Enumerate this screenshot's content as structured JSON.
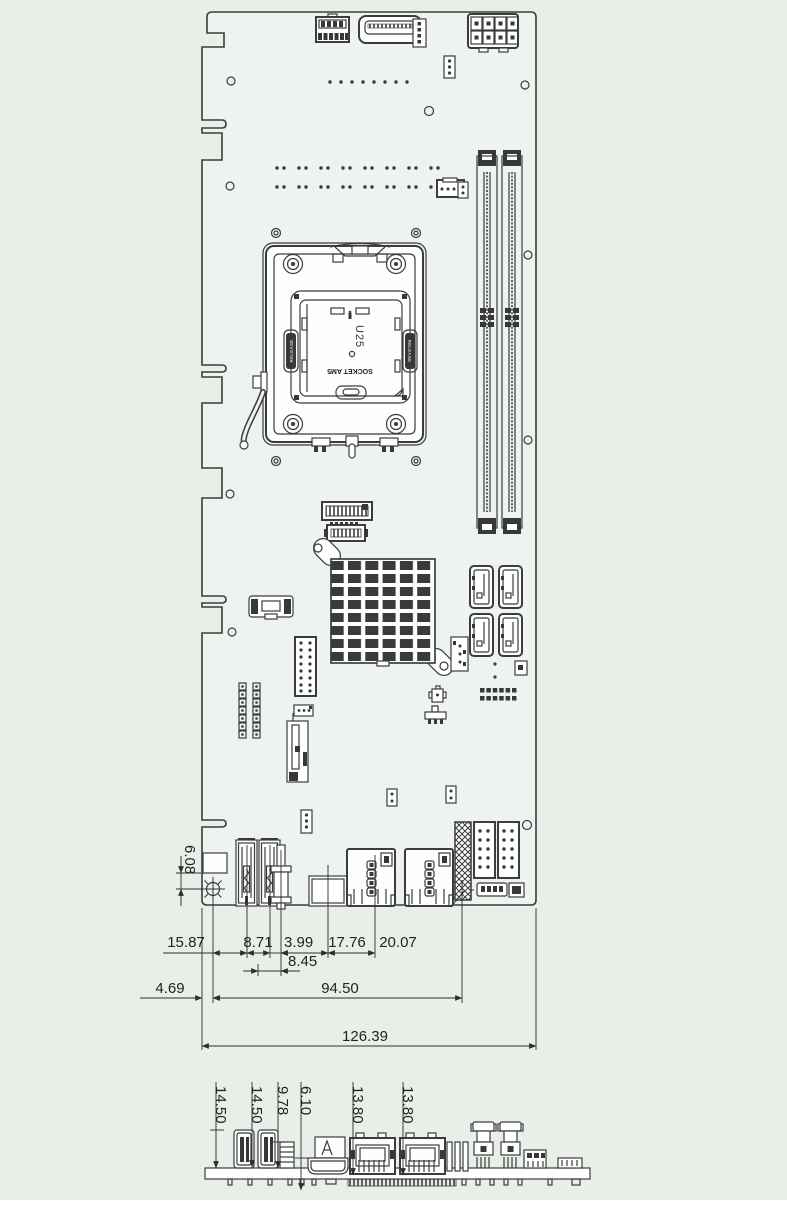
{
  "colors": {
    "background": "#e8efe9",
    "board_fill": "#edf3ee",
    "line": "#3c3c3c",
    "dim_line": "#2e2e2e"
  },
  "socket": {
    "designator": "U25",
    "type_label": "SOCKET AM5",
    "release_label": "RELEASE"
  },
  "dims_main": {
    "vertical_hole_offset": "6.08",
    "chain": [
      "15.87",
      "8.71",
      "3.99",
      "17.76",
      "20.07"
    ],
    "sub_chain": "8.45",
    "edge_to_hole": "4.69",
    "hole_span": "94.50",
    "total_width": "126.39"
  },
  "dims_side": [
    "14.50",
    "14.50",
    "9.78",
    "6.10",
    "13.80",
    "13.80"
  ]
}
